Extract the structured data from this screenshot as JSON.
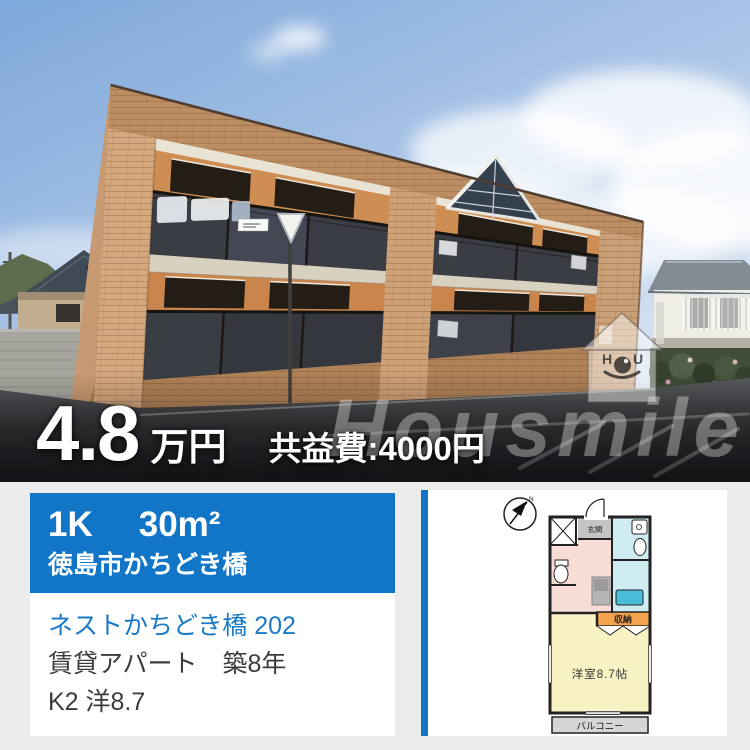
{
  "colors": {
    "accent_blue": "#1176c8",
    "link_blue": "#1b7ac8",
    "background_gray": "#ececec",
    "price_text": "#ffffff"
  },
  "photo": {
    "price": {
      "amount": "4.8",
      "unit": "万円",
      "fee": "共益費:4000円"
    },
    "watermark": {
      "brand": "Housmile",
      "logo_h": "H",
      "logo_o": "O",
      "logo_u": "U"
    }
  },
  "listing": {
    "header": {
      "layout": "1K",
      "area": "30m²",
      "location": "徳島市かちどき橋"
    },
    "details": {
      "name": "ネストかちどき橋 202",
      "building": "賃貸アパート　築8年",
      "rooms": "K2 洋8.7"
    }
  },
  "floorplan": {
    "labels": {
      "compass": "N",
      "entrance": "玄関",
      "storage": "収納",
      "room": "洋室8.7帖",
      "balcony": "バルコニー"
    }
  }
}
